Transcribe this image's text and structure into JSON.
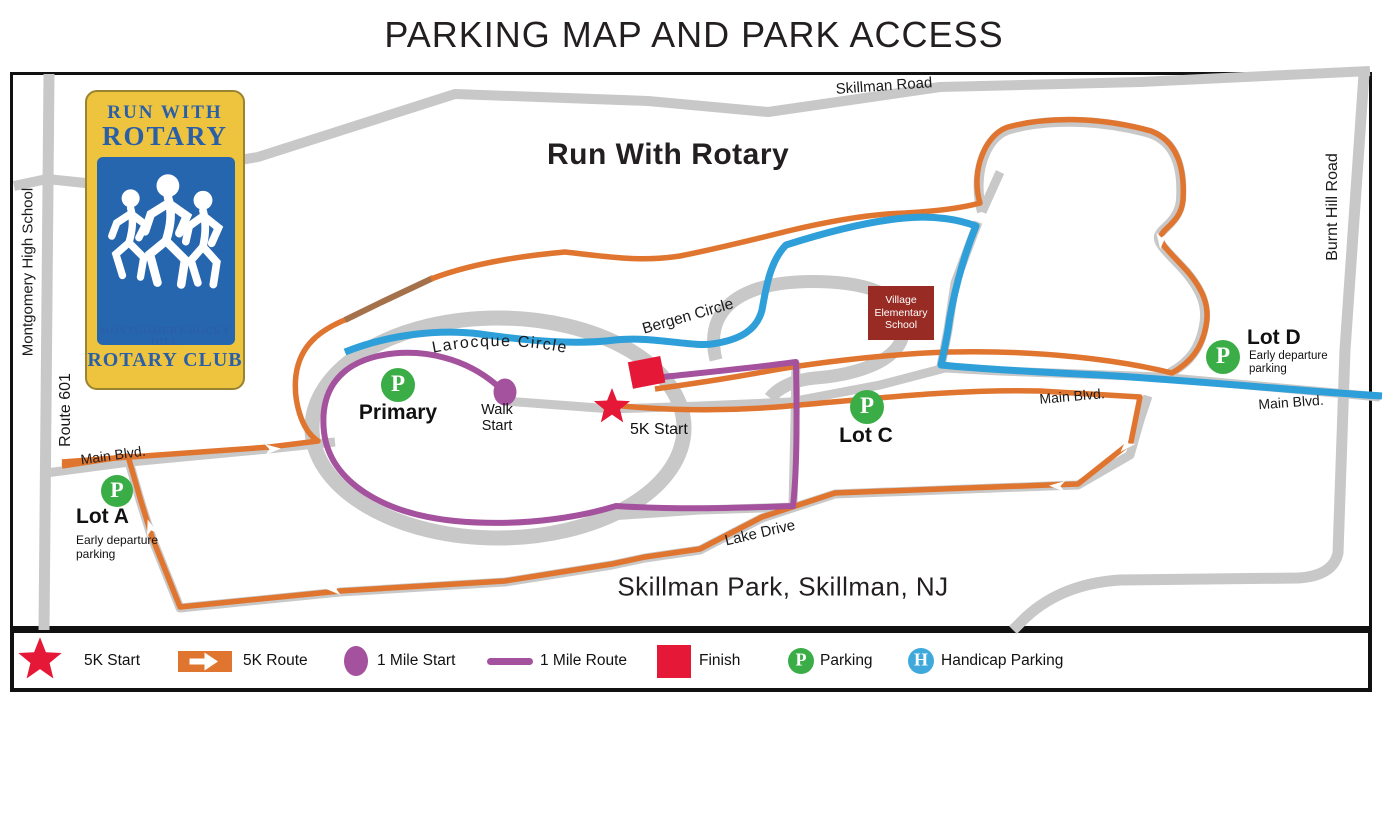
{
  "page": {
    "title": "PARKING MAP AND PARK ACCESS"
  },
  "logo": {
    "title_line1": "RUN WITH",
    "title_line2": "ROTARY",
    "subtitle_line1": "MONTGOMERY-ROCKY HILL",
    "subtitle_line2": "ROTARY CLUB",
    "colors": {
      "gold": "#EEC43F",
      "panel_blue": "#2666AE",
      "text_navy": "#2A5FA8"
    }
  },
  "map": {
    "heading": "Run With Rotary",
    "park_name": "Skillman Park, Skillman, NJ",
    "roads": {
      "skillman_road": "Skillman Road",
      "route_601": "Route 601",
      "burnt_hill_road": "Burnt Hill Road",
      "main_blvd": "Main Blvd.",
      "lake_drive": "Lake Drive",
      "larocque_circle": "Larocque Circle",
      "bergen_circle": "Bergen Circle"
    },
    "areas": {
      "montgomery_high_school": "Montgomery High School"
    },
    "school": {
      "line1": "Village",
      "line2": "Elementary",
      "line3": "School"
    },
    "lots": {
      "lot_a": {
        "name": "Lot A",
        "note_line1": "Early departure",
        "note_line2": "parking"
      },
      "lot_c": {
        "name": "Lot C"
      },
      "lot_d": {
        "name": "Lot D",
        "note_line1": "Early departure",
        "note_line2": "parking"
      },
      "primary": {
        "name": "Primary"
      }
    },
    "markers": {
      "walk_start_line1": "Walk",
      "walk_start_line2": "Start",
      "five_k_start": "5K Start",
      "parking_letter": "P"
    }
  },
  "legend": {
    "items": [
      {
        "label": "5K Start",
        "symbol": "red-star"
      },
      {
        "label": "5K Route",
        "symbol": "orange-arrow"
      },
      {
        "label": "1 Mile Start",
        "symbol": "purple-dot"
      },
      {
        "label": "1 Mile Route",
        "symbol": "purple-line"
      },
      {
        "label": "Finish",
        "symbol": "red-square"
      },
      {
        "label": "Parking",
        "symbol": "green-circle",
        "letter": "P"
      },
      {
        "label": "Handicap Parking",
        "symbol": "blue-circle",
        "letter": "H"
      }
    ]
  },
  "colors": {
    "road_gray": "#C8C8C8",
    "route_5k_orange": "#E0752F",
    "route_5k_brown": "#A5714B",
    "route_1mile_purple": "#A4529E",
    "access_blue": "#2E9FD8",
    "parking_green": "#3BAD46",
    "start_finish_red": "#E51937",
    "school_maroon": "#982B24"
  }
}
